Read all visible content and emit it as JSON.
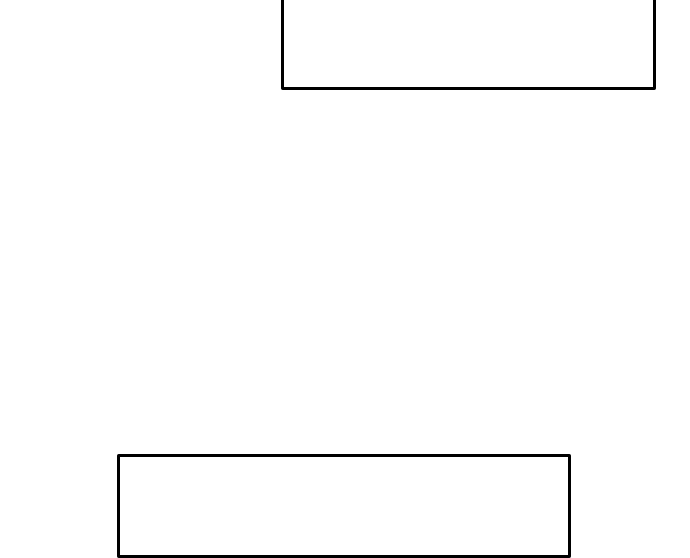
{
  "canvas": {
    "background_color": "#ffffff"
  },
  "shapes": {
    "top_rectangle": {
      "label": "",
      "border_color": "#000000",
      "fill_color": "#ffffff"
    },
    "bottom_rectangle": {
      "label": "",
      "border_color": "#000000",
      "fill_color": "#ffffff"
    }
  }
}
